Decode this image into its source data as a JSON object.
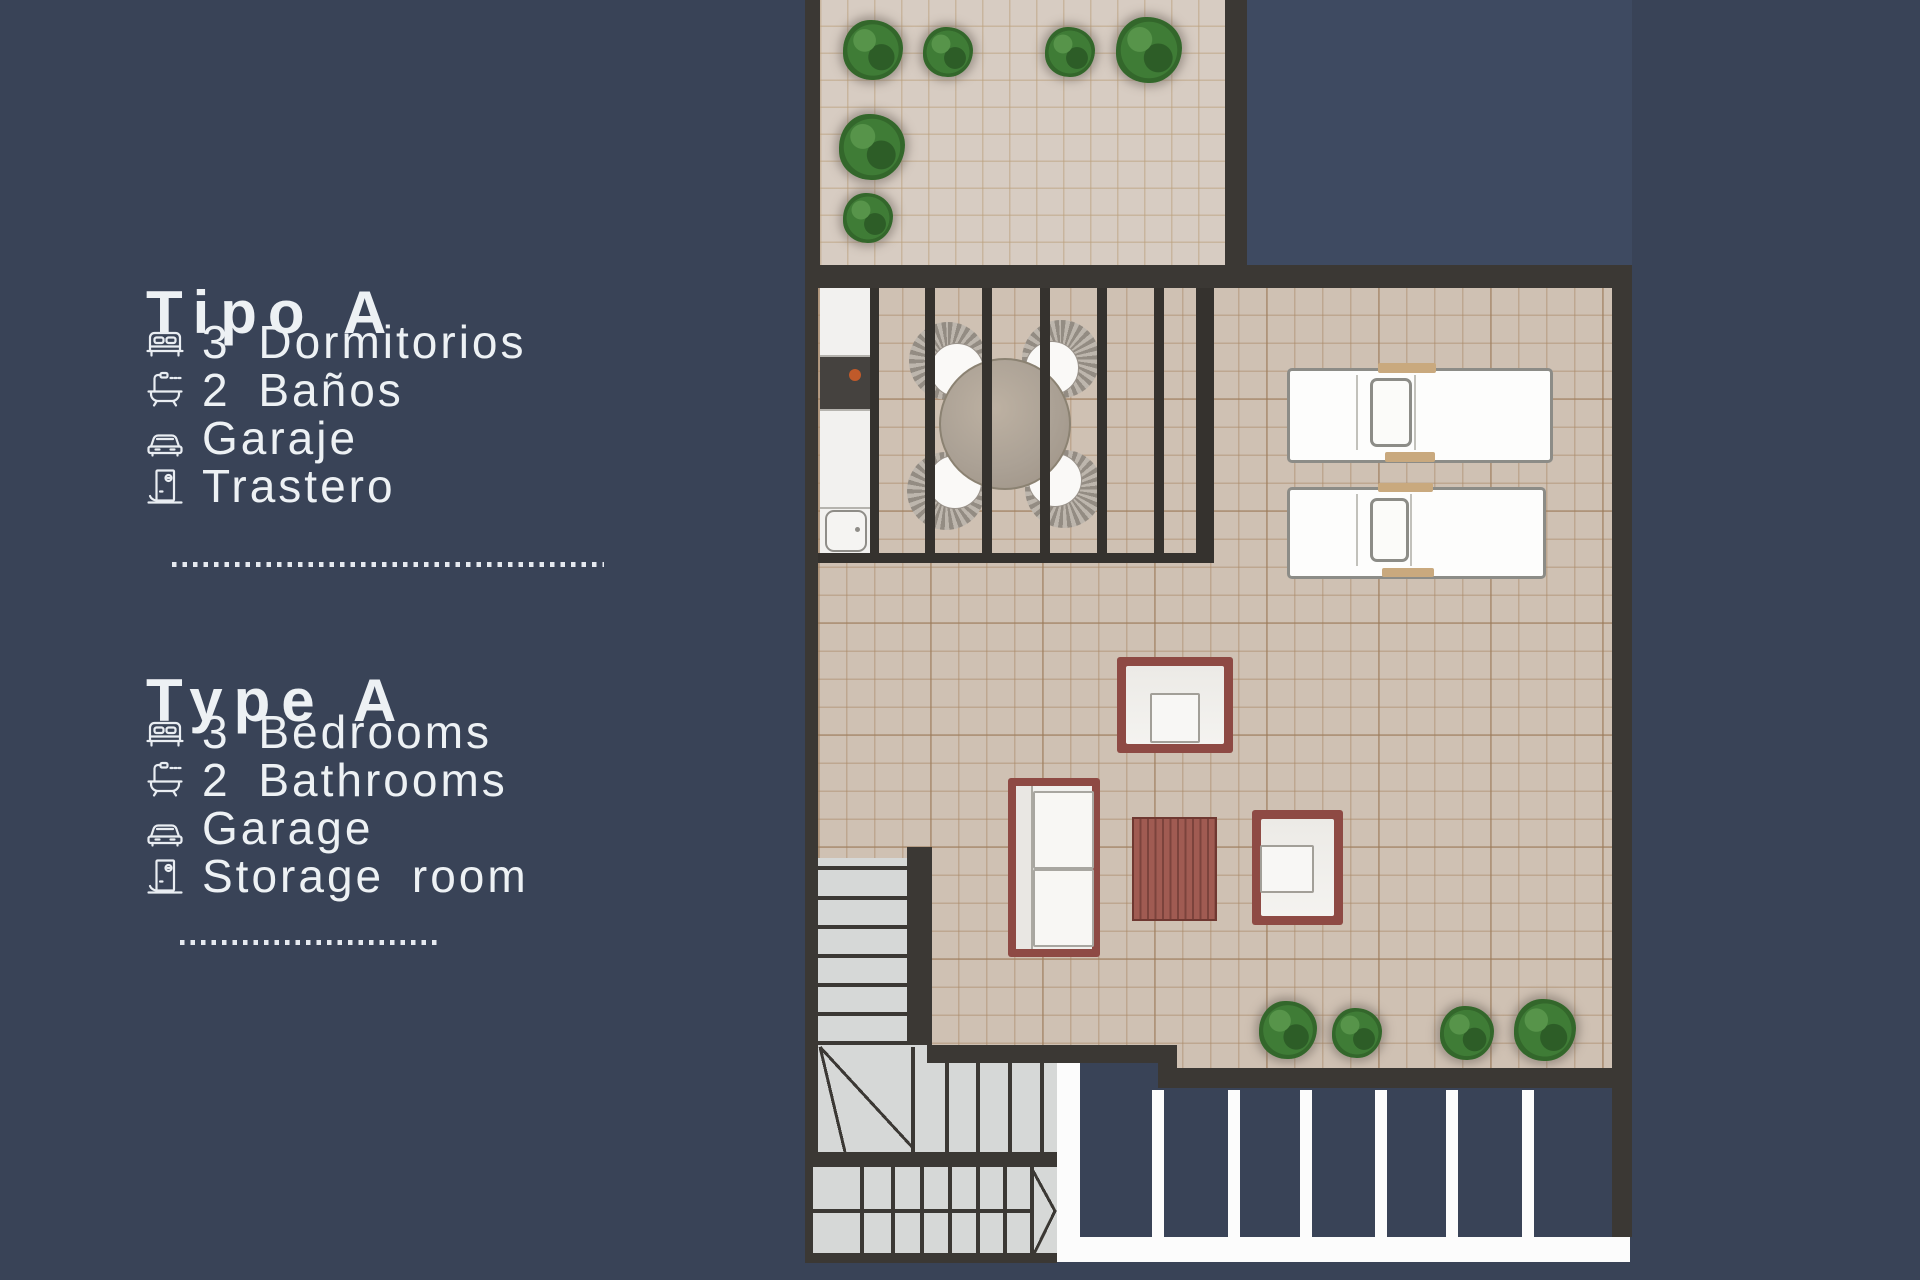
{
  "legend": {
    "sections": [
      {
        "title": "Tipo A",
        "items": [
          {
            "icon": "bed-icon",
            "label": "3 Dormitorios"
          },
          {
            "icon": "bathtub-icon",
            "label": "2 Baños"
          },
          {
            "icon": "car-icon",
            "label": "Garaje"
          },
          {
            "icon": "door-icon",
            "label": "Trastero"
          }
        ]
      },
      {
        "title": "Type A",
        "items": [
          {
            "icon": "bed-icon",
            "label": "3 Bedrooms"
          },
          {
            "icon": "bathtub-icon",
            "label": "2 Bathrooms"
          },
          {
            "icon": "car-icon",
            "label": "Garage"
          },
          {
            "icon": "door-icon",
            "label": "Storage room"
          }
        ]
      }
    ]
  },
  "floorplan": {
    "description": "Roof terrace plan of unit Type A",
    "colors": {
      "background": "#394357",
      "courtyard": "#3E4A61",
      "wall": "#3B3834",
      "terrace_floor": "#CFC1B3",
      "upper_terrace_floor": "#D7CCC2",
      "stair_tread": "#D6D8D7",
      "furniture_frame": "#8E4A44",
      "coffee_table": "#A05B52",
      "wood_accent": "#C9A97E",
      "plant_green": "#3F7C36",
      "deck_joists": "#FCFCFC",
      "text": "#EDF1F4"
    }
  }
}
